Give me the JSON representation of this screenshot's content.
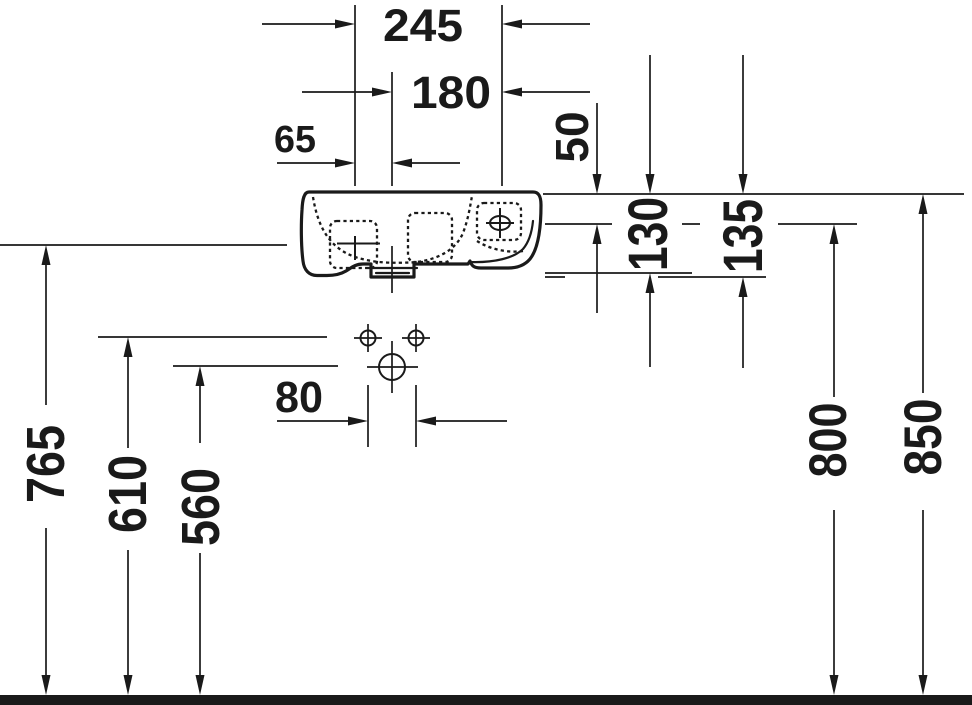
{
  "drawing": {
    "kind": "technical-dimension-drawing",
    "subject": "wall-mounted handrinse washbasin, front elevation",
    "units": "mm"
  },
  "colors": {
    "ink": "#1a1a1a",
    "background": "#ffffff"
  },
  "dims": {
    "d245": "245",
    "d180": "180",
    "d65": "65",
    "d80": "80",
    "d50": "50",
    "d130": "130",
    "d135": "135",
    "d765": "765",
    "d610": "610",
    "d560": "560",
    "d800": "800",
    "d850": "850"
  }
}
